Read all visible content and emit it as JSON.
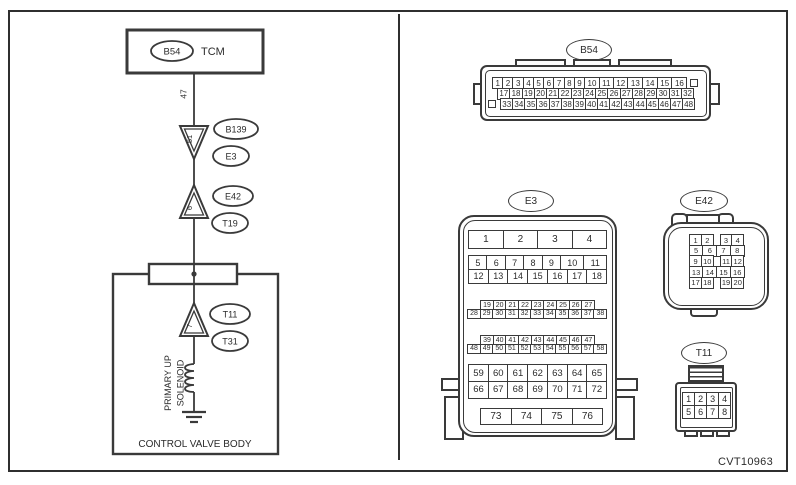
{
  "figure_code": "CVT10963",
  "schematic": {
    "tcm": {
      "connector": "B54",
      "label": "TCM",
      "pin": "47"
    },
    "joints": [
      {
        "pin": "51",
        "labels": [
          "B139",
          "E3"
        ]
      },
      {
        "pin": "6",
        "labels": [
          "E42",
          "T19"
        ]
      },
      {
        "pin": "7",
        "labels": [
          "T11",
          "T31"
        ]
      }
    ],
    "solenoid": {
      "line1": "PRIMARY UP",
      "line2": "SOLENOID"
    },
    "box_label": "CONTROL VALVE BODY"
  },
  "connector_views": {
    "b54": {
      "label": "B54",
      "rows": [
        [
          "1",
          "2",
          "3",
          "4",
          "5",
          "6",
          "7",
          "8",
          "9",
          "10",
          "11",
          "12",
          "13",
          "14",
          "15",
          "16",
          ""
        ],
        [
          "17",
          "18",
          "19",
          "20",
          "21",
          "22",
          "23",
          "24",
          "25",
          "26",
          "27",
          "28",
          "29",
          "30",
          "31",
          "32"
        ],
        [
          "",
          "33",
          "34",
          "35",
          "36",
          "37",
          "38",
          "39",
          "40",
          "41",
          "42",
          "43",
          "44",
          "45",
          "46",
          "47",
          "48"
        ]
      ]
    },
    "e3": {
      "label": "E3",
      "rows": [
        [
          "1",
          "2",
          "3",
          "4"
        ],
        [
          "5",
          "6",
          "7",
          "8",
          "9",
          "10",
          "11"
        ],
        [
          "12",
          "13",
          "14",
          "15",
          "16",
          "17",
          "18"
        ],
        [
          "19",
          "20",
          "21",
          "22",
          "23",
          "24",
          "25",
          "26",
          "27"
        ],
        [
          "28",
          "29",
          "30",
          "31",
          "32",
          "33",
          "34",
          "35",
          "36",
          "37",
          "38"
        ],
        [
          "39",
          "40",
          "41",
          "42",
          "43",
          "44",
          "45",
          "46",
          "47"
        ],
        [
          "48",
          "49",
          "50",
          "51",
          "52",
          "53",
          "54",
          "55",
          "56",
          "57",
          "58"
        ],
        [
          "59",
          "60",
          "61",
          "62",
          "63",
          "64",
          "65"
        ],
        [
          "66",
          "67",
          "68",
          "69",
          "70",
          "71",
          "72"
        ],
        [
          "73",
          "74",
          "75",
          "76"
        ]
      ]
    },
    "e42": {
      "label": "E42",
      "rows": [
        [
          "1",
          "2",
          "_",
          "3",
          "4"
        ],
        [
          "5",
          "6",
          "7",
          "8"
        ],
        [
          "9",
          "10",
          "_",
          "11",
          "12"
        ],
        [
          "13",
          "14",
          "15",
          "16"
        ],
        [
          "17",
          "18",
          "_",
          "19",
          "20"
        ]
      ]
    },
    "t11": {
      "label": "T11",
      "rows": [
        [
          "1",
          "2",
          "3",
          "4"
        ],
        [
          "5",
          "6",
          "7",
          "8"
        ]
      ]
    }
  }
}
